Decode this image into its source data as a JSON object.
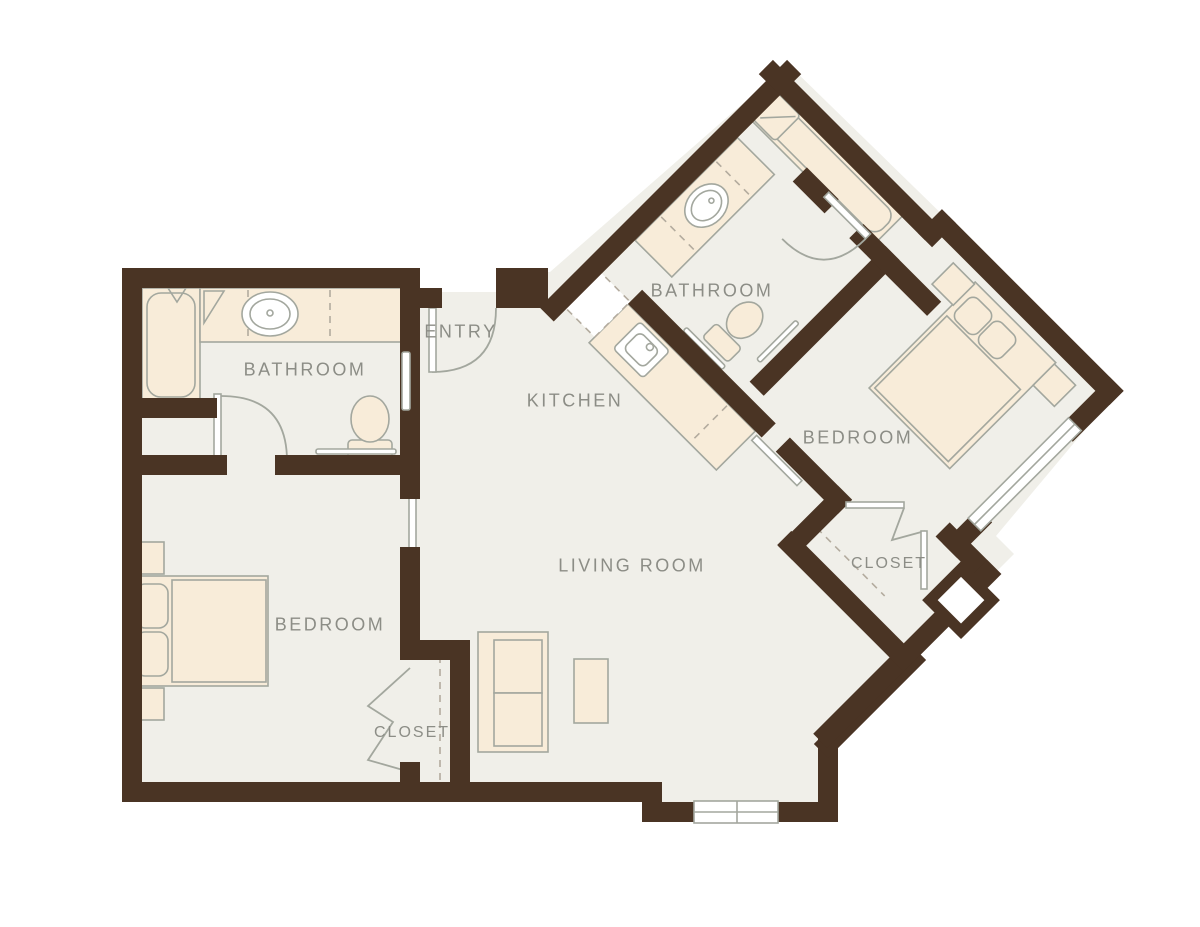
{
  "title": "Apartment floor plan",
  "rooms": [
    {
      "id": "bathroom-1",
      "label": "BATHROOM"
    },
    {
      "id": "entry",
      "label": "ENTRY"
    },
    {
      "id": "kitchen",
      "label": "KITCHEN"
    },
    {
      "id": "bathroom-2",
      "label": "BATHROOM"
    },
    {
      "id": "bedroom-2",
      "label": "BEDROOM"
    },
    {
      "id": "living-room",
      "label": "LIVING ROOM"
    },
    {
      "id": "bedroom-1",
      "label": "BEDROOM"
    },
    {
      "id": "closet-2",
      "label": "CLOSET"
    },
    {
      "id": "closet-1",
      "label": "CLOSET"
    }
  ],
  "colors": {
    "wall": "#4a3424",
    "floor": "#f0efe9",
    "fixture": "#f8ecd9",
    "outline": "#a3a79e",
    "label": "#8c8d86",
    "dash": "#b3ab9e"
  }
}
